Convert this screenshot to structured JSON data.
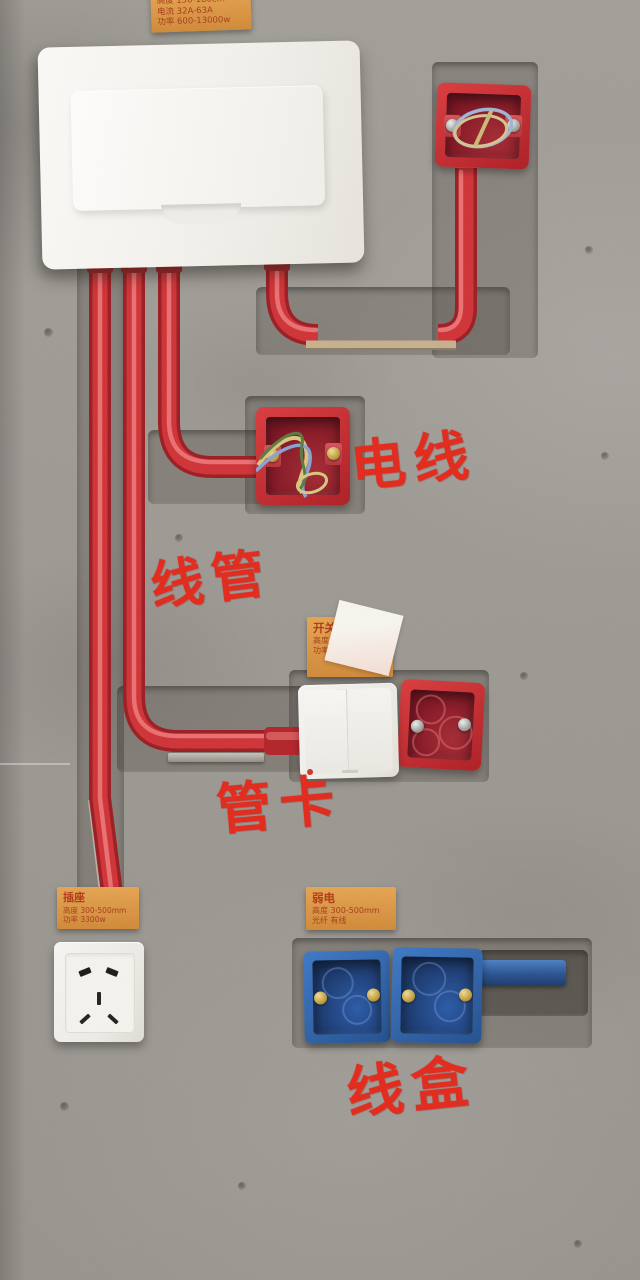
{
  "annotations": {
    "wire": "电线",
    "conduit": "线管",
    "clamp": "管卡",
    "junction_box": "线盒",
    "color": "#e3291b"
  },
  "stickers": {
    "panel_spec": {
      "line1": "高度 150-180cm",
      "line2": "电流 32A-63A",
      "line3": "功率 600-13000w"
    },
    "switch_spec": {
      "title": "开关",
      "line1": "高度 1300mm",
      "line2": "功率 1500W"
    },
    "socket_spec": {
      "title": "插座",
      "line1": "高度 300-500mm",
      "line2": "功率 3300w"
    },
    "weak_current_spec": {
      "title": "弱电",
      "line1": "高度 300-500mm",
      "line2": "光纤 有线"
    }
  },
  "colors": {
    "wall_grey": "#9d9a94",
    "conduit_red": "#c42629",
    "junction_box_red": "#c0242c",
    "junction_box_blue": "#2e62ac",
    "sticker_orange": "#dd9a46",
    "sticker_text": "#a83b1c",
    "cable_tan": "#c6b08f",
    "panel_white": "#f4f2ee"
  }
}
